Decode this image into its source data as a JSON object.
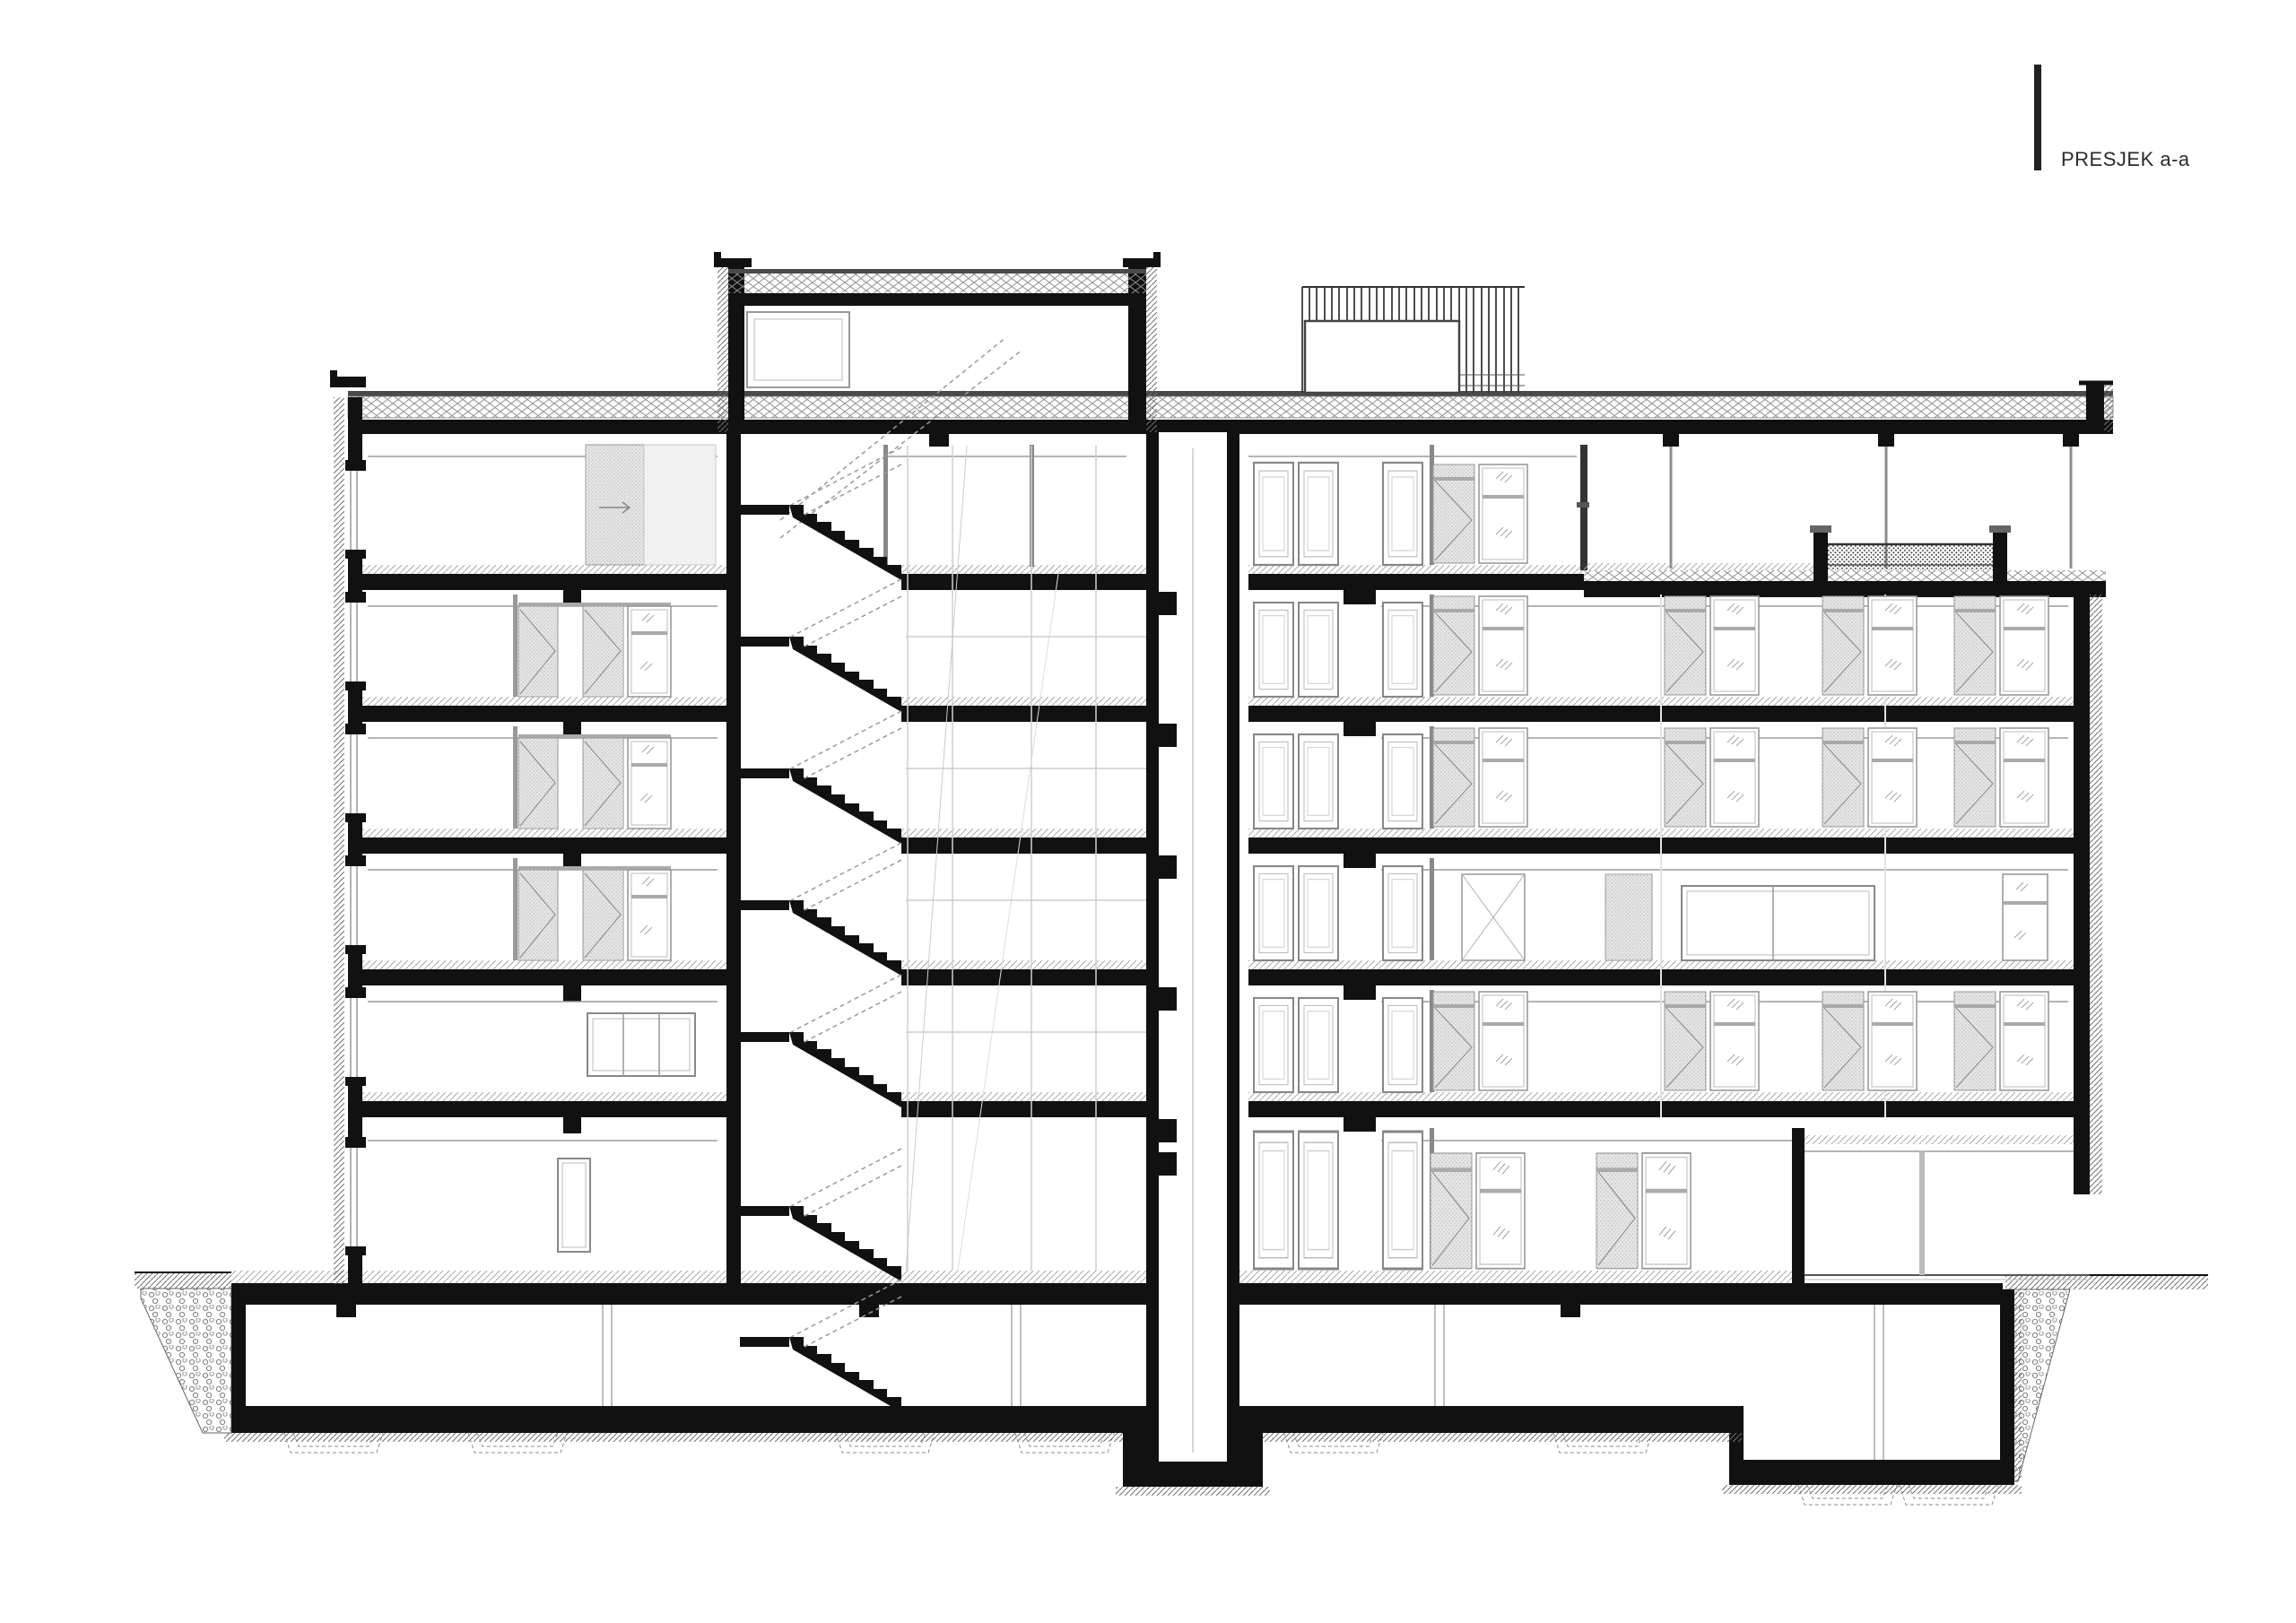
{
  "title_block": {
    "label": "PRESJEK a-a",
    "marker": "vertical-tick-bar"
  },
  "colors": {
    "paper": "#ffffff",
    "ink": "#111111",
    "mid_line": "#888888",
    "light_line": "#bbbbbb",
    "panel_fill": "#e7e7e7"
  }
}
